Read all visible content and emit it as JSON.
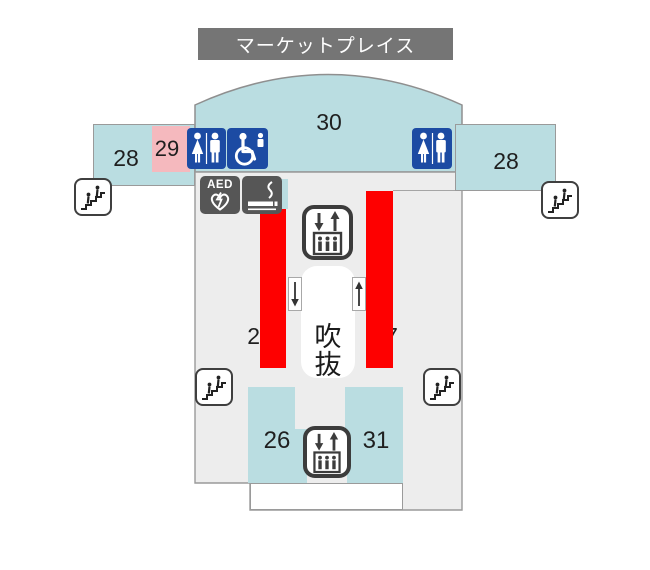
{
  "title": "マーケットプレイス",
  "areas": {
    "north_left": "28",
    "north_room": "29",
    "north_hall": "30",
    "north_right": "28",
    "west_shop_partial": "2",
    "east_shop_partial": "7",
    "atrium": "吹抜",
    "south_left": "26",
    "south_right": "31"
  },
  "facility_icons": {
    "restroom": "restroom-icon",
    "accessible_restroom": "wheelchair-accessible-icon",
    "aed_label": "AED",
    "smoking": "smoking-area-icon",
    "elevator": "elevator-icon",
    "escalator": "escalator-icon",
    "down_arrow": "↓",
    "up_arrow": "↑"
  },
  "colors": {
    "zone_teal": "#badde1",
    "zone_pink": "#f5b9be",
    "highlight_red": "#fe0000",
    "icon_blue": "#1c4ba3",
    "icon_dark_gray": "#565656",
    "banner_gray": "#757575",
    "floor_gray": "#ededed"
  }
}
